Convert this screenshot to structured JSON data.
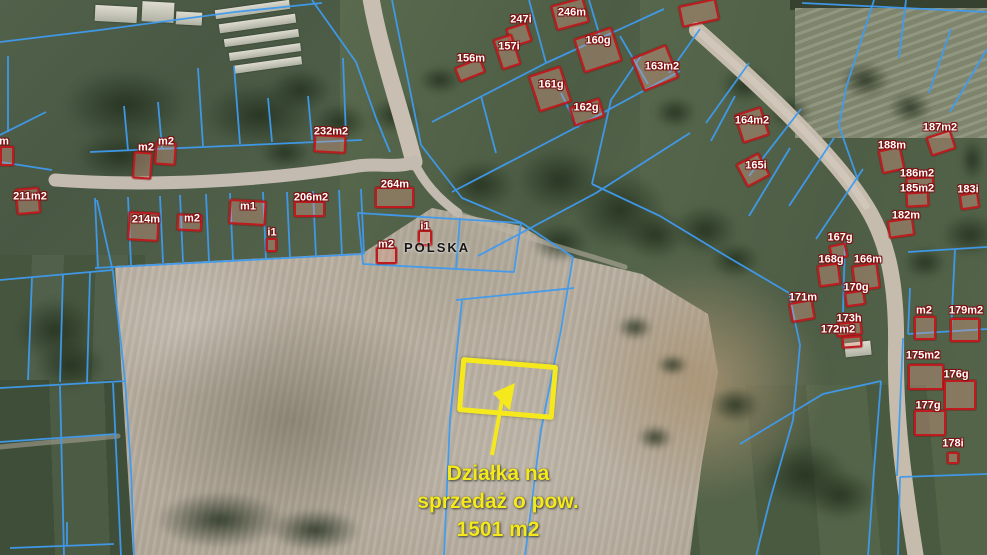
{
  "map": {
    "place_label": "POLSKA",
    "annotation": {
      "line1": "Działka na",
      "line2": "sprzedaż o pow.",
      "line3": "1501 m2"
    },
    "colors": {
      "parcel_line": "#3f9bef",
      "building_outline": "#bf1b1e",
      "highlight_yellow": "#f5e91d",
      "road": "#c6bcae",
      "field": "#bdb4a6"
    },
    "buildings": [
      {
        "label": "247i",
        "x": 508,
        "y": 25,
        "w": 22,
        "h": 20,
        "r": -18,
        "lx": 521,
        "ly": 20
      },
      {
        "label": "246m",
        "x": 553,
        "y": 1,
        "w": 34,
        "h": 26,
        "r": -15,
        "lx": 572,
        "ly": 13
      },
      {
        "label": "156m",
        "x": 456,
        "y": 62,
        "w": 28,
        "h": 16,
        "r": -22,
        "lx": 471,
        "ly": 59
      },
      {
        "label": "157i",
        "x": 497,
        "y": 36,
        "w": 20,
        "h": 32,
        "r": -18,
        "lx": 509,
        "ly": 47
      },
      {
        "label": "160g",
        "x": 578,
        "y": 32,
        "w": 40,
        "h": 36,
        "r": -18,
        "lx": 598,
        "ly": 41
      },
      {
        "label": "161g",
        "x": 533,
        "y": 70,
        "w": 34,
        "h": 38,
        "r": -18,
        "lx": 551,
        "ly": 85
      },
      {
        "label": "162g",
        "x": 571,
        "y": 102,
        "w": 32,
        "h": 20,
        "r": -18,
        "lx": 586,
        "ly": 108
      },
      {
        "label": "163m2",
        "x": 636,
        "y": 50,
        "w": 38,
        "h": 36,
        "r": -22,
        "lx": 662,
        "ly": 67
      },
      {
        "label": "164m2",
        "x": 738,
        "y": 110,
        "w": 28,
        "h": 30,
        "r": -18,
        "lx": 752,
        "ly": 121
      },
      {
        "label": "165i",
        "x": 740,
        "y": 157,
        "w": 26,
        "h": 26,
        "r": -28,
        "lx": 756,
        "ly": 166
      },
      {
        "label": "187m2",
        "x": 928,
        "y": 133,
        "w": 26,
        "h": 20,
        "r": -18,
        "lx": 940,
        "ly": 128
      },
      {
        "label": "188m",
        "x": 880,
        "y": 148,
        "w": 23,
        "h": 24,
        "r": -12,
        "lx": 892,
        "ly": 146
      },
      {
        "label": "186m2",
        "x": 906,
        "y": 177,
        "w": 28,
        "h": 13,
        "r": -3,
        "lx": 917,
        "ly": 174
      },
      {
        "label": "185m2",
        "x": 906,
        "y": 192,
        "w": 23,
        "h": 15,
        "r": -3,
        "lx": 917,
        "ly": 189
      },
      {
        "label": "183i",
        "x": 960,
        "y": 193,
        "w": 19,
        "h": 16,
        "r": -8,
        "lx": 968,
        "ly": 190
      },
      {
        "label": "182m",
        "x": 888,
        "y": 219,
        "w": 26,
        "h": 18,
        "r": -8,
        "lx": 906,
        "ly": 216
      },
      {
        "label": "167g",
        "x": 830,
        "y": 244,
        "w": 17,
        "h": 15,
        "r": -12,
        "lx": 840,
        "ly": 238
      },
      {
        "label": "168g",
        "x": 818,
        "y": 264,
        "w": 22,
        "h": 22,
        "r": -8,
        "lx": 831,
        "ly": 260
      },
      {
        "label": "166m",
        "x": 853,
        "y": 264,
        "w": 26,
        "h": 26,
        "r": -8,
        "lx": 868,
        "ly": 260
      },
      {
        "label": "170g",
        "x": 845,
        "y": 291,
        "w": 20,
        "h": 15,
        "r": -8,
        "lx": 856,
        "ly": 288
      },
      {
        "label": "171m",
        "x": 790,
        "y": 301,
        "w": 24,
        "h": 20,
        "r": -10,
        "lx": 803,
        "ly": 298
      },
      {
        "label": "173h",
        "x": 836,
        "y": 322,
        "w": 26,
        "h": 14,
        "r": -6,
        "lx": 849,
        "ly": 319
      },
      {
        "label": "172m2",
        "x": 842,
        "y": 336,
        "w": 20,
        "h": 12,
        "r": -4,
        "lx": 838,
        "ly": 330
      },
      {
        "label": "m2",
        "x": 914,
        "y": 316,
        "w": 22,
        "h": 24,
        "r": 0,
        "lx": 924,
        "ly": 311
      },
      {
        "label": "179m2",
        "x": 950,
        "y": 318,
        "w": 30,
        "h": 24,
        "r": 0,
        "lx": 966,
        "ly": 311
      },
      {
        "label": "175m2",
        "x": 908,
        "y": 364,
        "w": 36,
        "h": 26,
        "r": 0,
        "lx": 923,
        "ly": 356
      },
      {
        "label": "176g",
        "x": 944,
        "y": 380,
        "w": 32,
        "h": 30,
        "r": 0,
        "lx": 956,
        "ly": 375
      },
      {
        "label": "177g",
        "x": 914,
        "y": 410,
        "w": 32,
        "h": 26,
        "r": 0,
        "lx": 928,
        "ly": 406
      },
      {
        "label": "178i",
        "x": 947,
        "y": 452,
        "w": 12,
        "h": 12,
        "r": 0,
        "lx": 953,
        "ly": 444
      },
      {
        "label": "211m2",
        "x": 16,
        "y": 188,
        "w": 24,
        "h": 26,
        "r": -5,
        "lx": 30,
        "ly": 197
      },
      {
        "label": "m",
        "x": 0,
        "y": 146,
        "w": 14,
        "h": 20,
        "r": 0,
        "lx": 4,
        "ly": 142
      },
      {
        "label": "m2",
        "x": 133,
        "y": 152,
        "w": 19,
        "h": 27,
        "r": 4,
        "lx": 146,
        "ly": 148
      },
      {
        "label": "m2",
        "x": 155,
        "y": 142,
        "w": 21,
        "h": 23,
        "r": 4,
        "lx": 166,
        "ly": 142
      },
      {
        "label": "214m",
        "x": 128,
        "y": 212,
        "w": 31,
        "h": 29,
        "r": 3,
        "lx": 146,
        "ly": 220
      },
      {
        "label": "m2",
        "x": 177,
        "y": 214,
        "w": 25,
        "h": 17,
        "r": 3,
        "lx": 192,
        "ly": 219
      },
      {
        "label": "m1",
        "x": 229,
        "y": 200,
        "w": 37,
        "h": 25,
        "r": 3,
        "lx": 248,
        "ly": 207
      },
      {
        "label": "i1",
        "x": 266,
        "y": 238,
        "w": 11,
        "h": 14,
        "r": 0,
        "lx": 272,
        "ly": 233
      },
      {
        "label": "232m2",
        "x": 314,
        "y": 135,
        "w": 32,
        "h": 18,
        "r": 3,
        "lx": 331,
        "ly": 132
      },
      {
        "label": "264m",
        "x": 375,
        "y": 187,
        "w": 39,
        "h": 21,
        "r": 0,
        "lx": 395,
        "ly": 185
      },
      {
        "label": "206m2",
        "x": 294,
        "y": 201,
        "w": 31,
        "h": 16,
        "r": 0,
        "lx": 311,
        "ly": 198
      },
      {
        "label": "m2",
        "x": 376,
        "y": 247,
        "w": 21,
        "h": 17,
        "r": 0,
        "lx": 386,
        "ly": 245
      },
      {
        "label": "i1",
        "x": 418,
        "y": 230,
        "w": 14,
        "h": 16,
        "r": 0,
        "lx": 425,
        "ly": 227
      },
      {
        "label": "",
        "x": 680,
        "y": 2,
        "w": 38,
        "h": 22,
        "r": -12,
        "lx": 699,
        "ly": 0
      }
    ]
  }
}
